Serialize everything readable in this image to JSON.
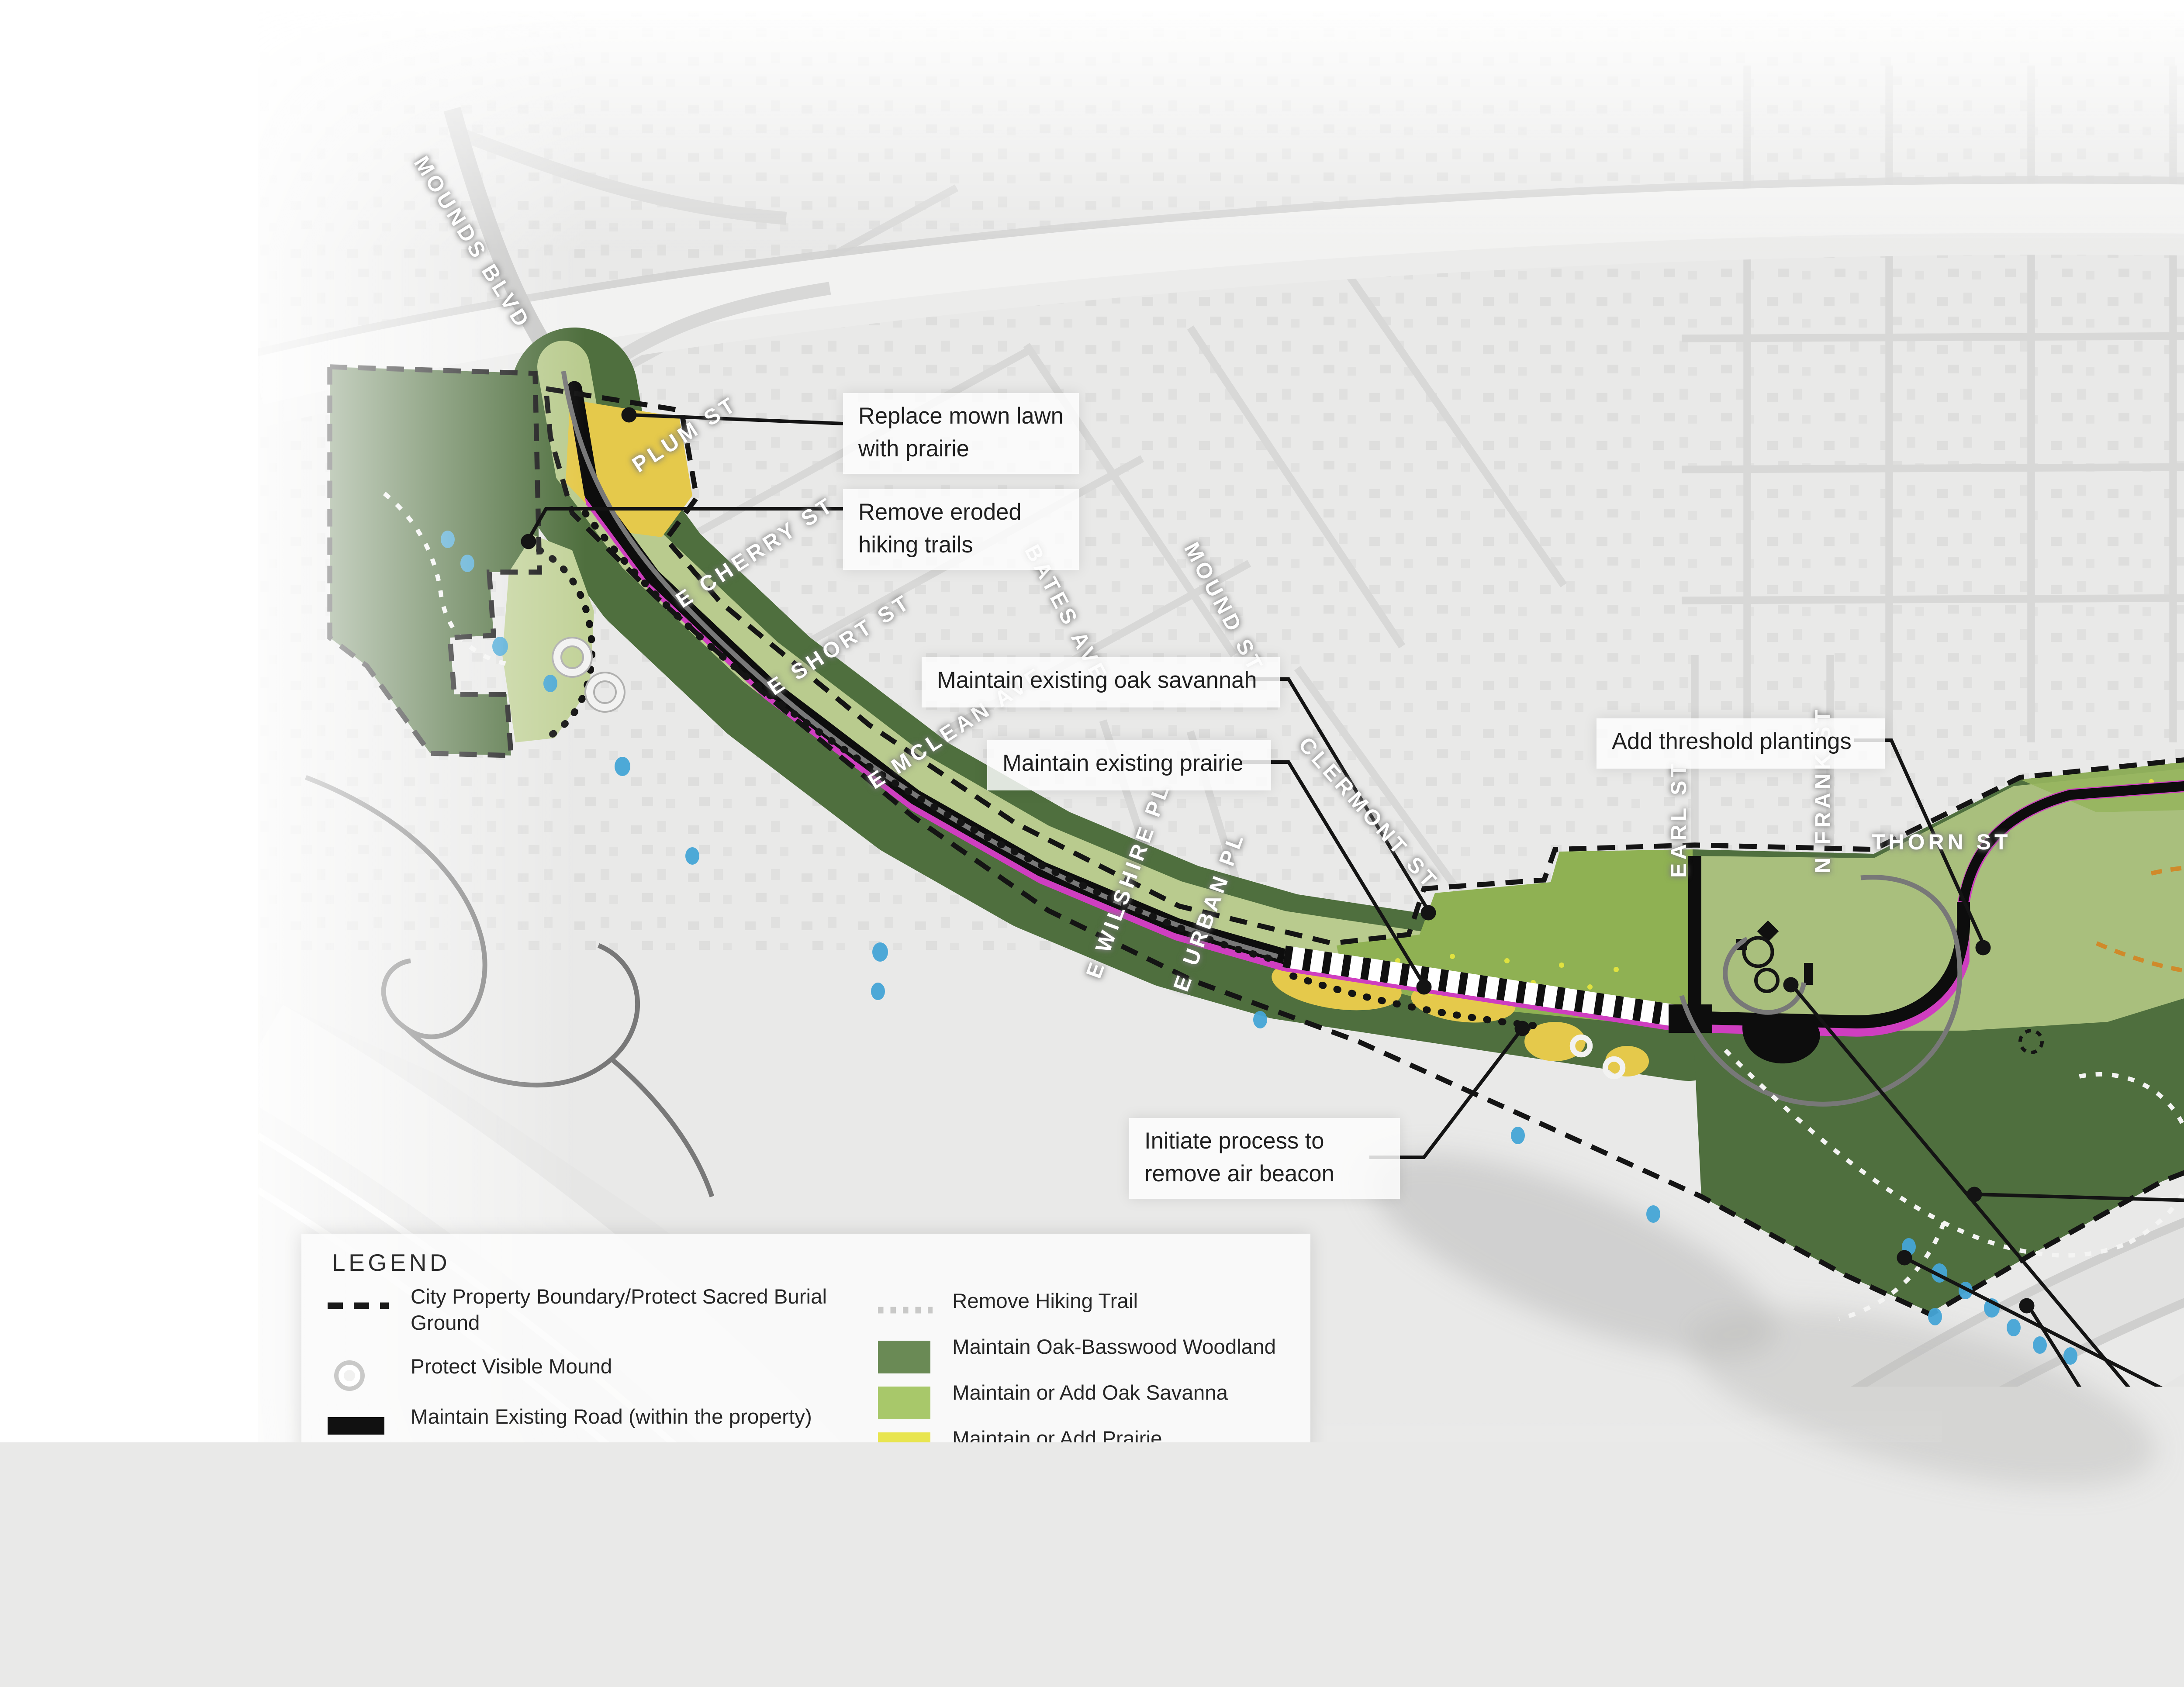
{
  "title": {
    "line1": "PHASE 1",
    "line2": "LANDSCAPE CONDITION"
  },
  "legend": {
    "header": "LEGEND",
    "left_items": [
      {
        "label": "City Property Boundary/Protect Sacred Burial Ground",
        "symbol": "dashed-boundary-line",
        "color": "#1a1a1a"
      },
      {
        "label": "Protect Visible Mound",
        "symbol": "white-ring",
        "color": "#ffffff"
      },
      {
        "label": "Maintain Existing Road (within the property)",
        "symbol": "thick-black-bar",
        "color": "#111111"
      },
      {
        "label": "Maintain Multi-Use Trail",
        "symbol": "thin-dark-line",
        "color": "#3a3a3a"
      },
      {
        "label": "Maintain or Add Hiking Trail",
        "symbol": "orange-dotted-line",
        "color": "#c8882b"
      },
      {
        "label": "Traffic Calming",
        "symbol": "striped-bar",
        "color": "#8f8f8f"
      }
    ],
    "right_items": [
      {
        "label": "Remove Hiking Trail",
        "symbol": "gray-dotted-line",
        "color": "#c9c9c8"
      },
      {
        "label": "Maintain Oak-Basswood Woodland",
        "symbol": "swatch",
        "color": "#6a8a55"
      },
      {
        "label": "Maintain or Add Oak Savanna",
        "symbol": "swatch",
        "color": "#a8c86a"
      },
      {
        "label": "Maintain or Add Prairie",
        "symbol": "swatch",
        "color": "#e8e54f"
      },
      {
        "label": "Maintain Existing Lawn",
        "symbol": "swatch",
        "color": "#a2a865"
      },
      {
        "label": "Maintain Spring",
        "symbol": "ellipse",
        "color": "#7ecbee"
      },
      {
        "label": "Add Threshold Vegetative Band",
        "symbol": "swatch",
        "color": "#dba8ce"
      }
    ]
  },
  "annotations": [
    "Replace mown lawn with prairie",
    "Remove eroded hiking trails",
    "Maintain existing oak savannah",
    "Maintain existing prairie",
    "Add threshold plantings",
    "Initiate process to remove air beacon",
    "Replace mown lawn with prairie",
    "Add stone seating",
    "Add stone seating",
    "Remove eroded hiking trails",
    "Implement messaging at Pavilion",
    "Retain fences until THPOs feel they can be removed"
  ],
  "streets": [
    "MOUNDS BLVD",
    "PLUM ST",
    "E CHERRY ST",
    "E SHORT ST",
    "E MCLEAN AVE",
    "BATES AVE",
    "MOUND ST",
    "E WILSHIRE PL",
    "E URBAN PL",
    "CLERMONT ST",
    "EARL ST",
    "N FRANK ST",
    "THORN ST",
    "BURNS AVE"
  ],
  "scale_bar": {
    "labels": [
      "0",
      "300",
      "600",
      "1200 ft"
    ]
  },
  "north_arrow": {
    "label": "N"
  },
  "colors": {
    "woodland": "#4f6f3e",
    "savanna": "#8fb153",
    "savanna_light": "#96b55e",
    "lawn": "#b9cb8e",
    "lawn_light": "#a9bf7d",
    "prairie": "#e5c94b",
    "threshold_band": "#cf3ec0",
    "spring_map": "#45a5d6",
    "road": "#0d0d0d",
    "boundary": "#141414",
    "hiking_trail": "#d08a2a",
    "remove_trail": "#f4f4f3",
    "multiuse_trail": "#787878",
    "title_text": "#5d6259"
  }
}
